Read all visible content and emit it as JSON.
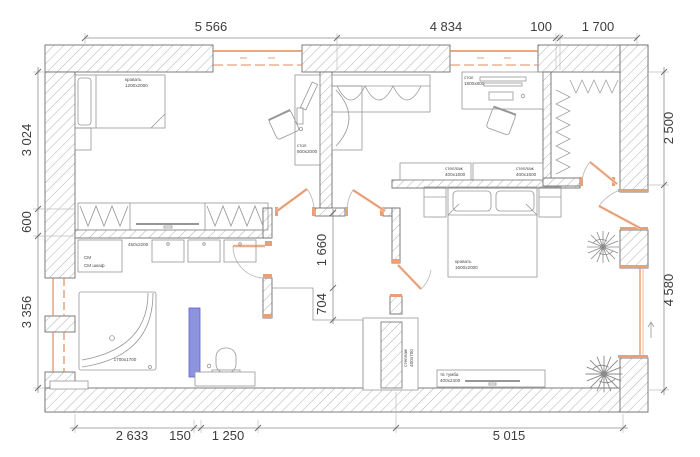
{
  "plan_title": "apartment floor plan",
  "dims": {
    "top": [
      "5 566",
      "4 834",
      "100",
      "1 700"
    ],
    "left": [
      "3 024",
      "600",
      "3 356"
    ],
    "right": [
      "2 500",
      "4 580"
    ],
    "bottom": [
      "2 633",
      "150",
      "1 250",
      "5 015"
    ],
    "inner": [
      "1 660",
      "704"
    ]
  },
  "furniture": {
    "bed1": {
      "name": "кровать",
      "size": "1200x2000"
    },
    "desk1": {
      "name": "стол",
      "size": "600x2000"
    },
    "desk2": {
      "name": "стол",
      "size": "1800x800"
    },
    "shelf": {
      "name": "стеллаж",
      "size": "400x1600"
    },
    "bed2": {
      "name": "кровать",
      "size": "1600x2000"
    },
    "tv_stand": {
      "name": "тв тумба",
      "size": "400x2400"
    },
    "cabinet": {
      "size": "450x2200"
    },
    "washer": {
      "line1": "СМ",
      "line2": "СМ шкаф"
    },
    "tub": {
      "size": "1700x1700"
    },
    "column_unit": {
      "name": "стеллаж",
      "size": "400x700"
    }
  },
  "colors": {
    "wall_outline": "#6e6e6e",
    "hatch": "#b1b1b1",
    "window_orange": "#e08b5e",
    "window_light": "#f7d3bd",
    "partition_blue": "#8d93dd",
    "dim_text": "#3d3d3d",
    "furniture_stroke": "#969696"
  }
}
